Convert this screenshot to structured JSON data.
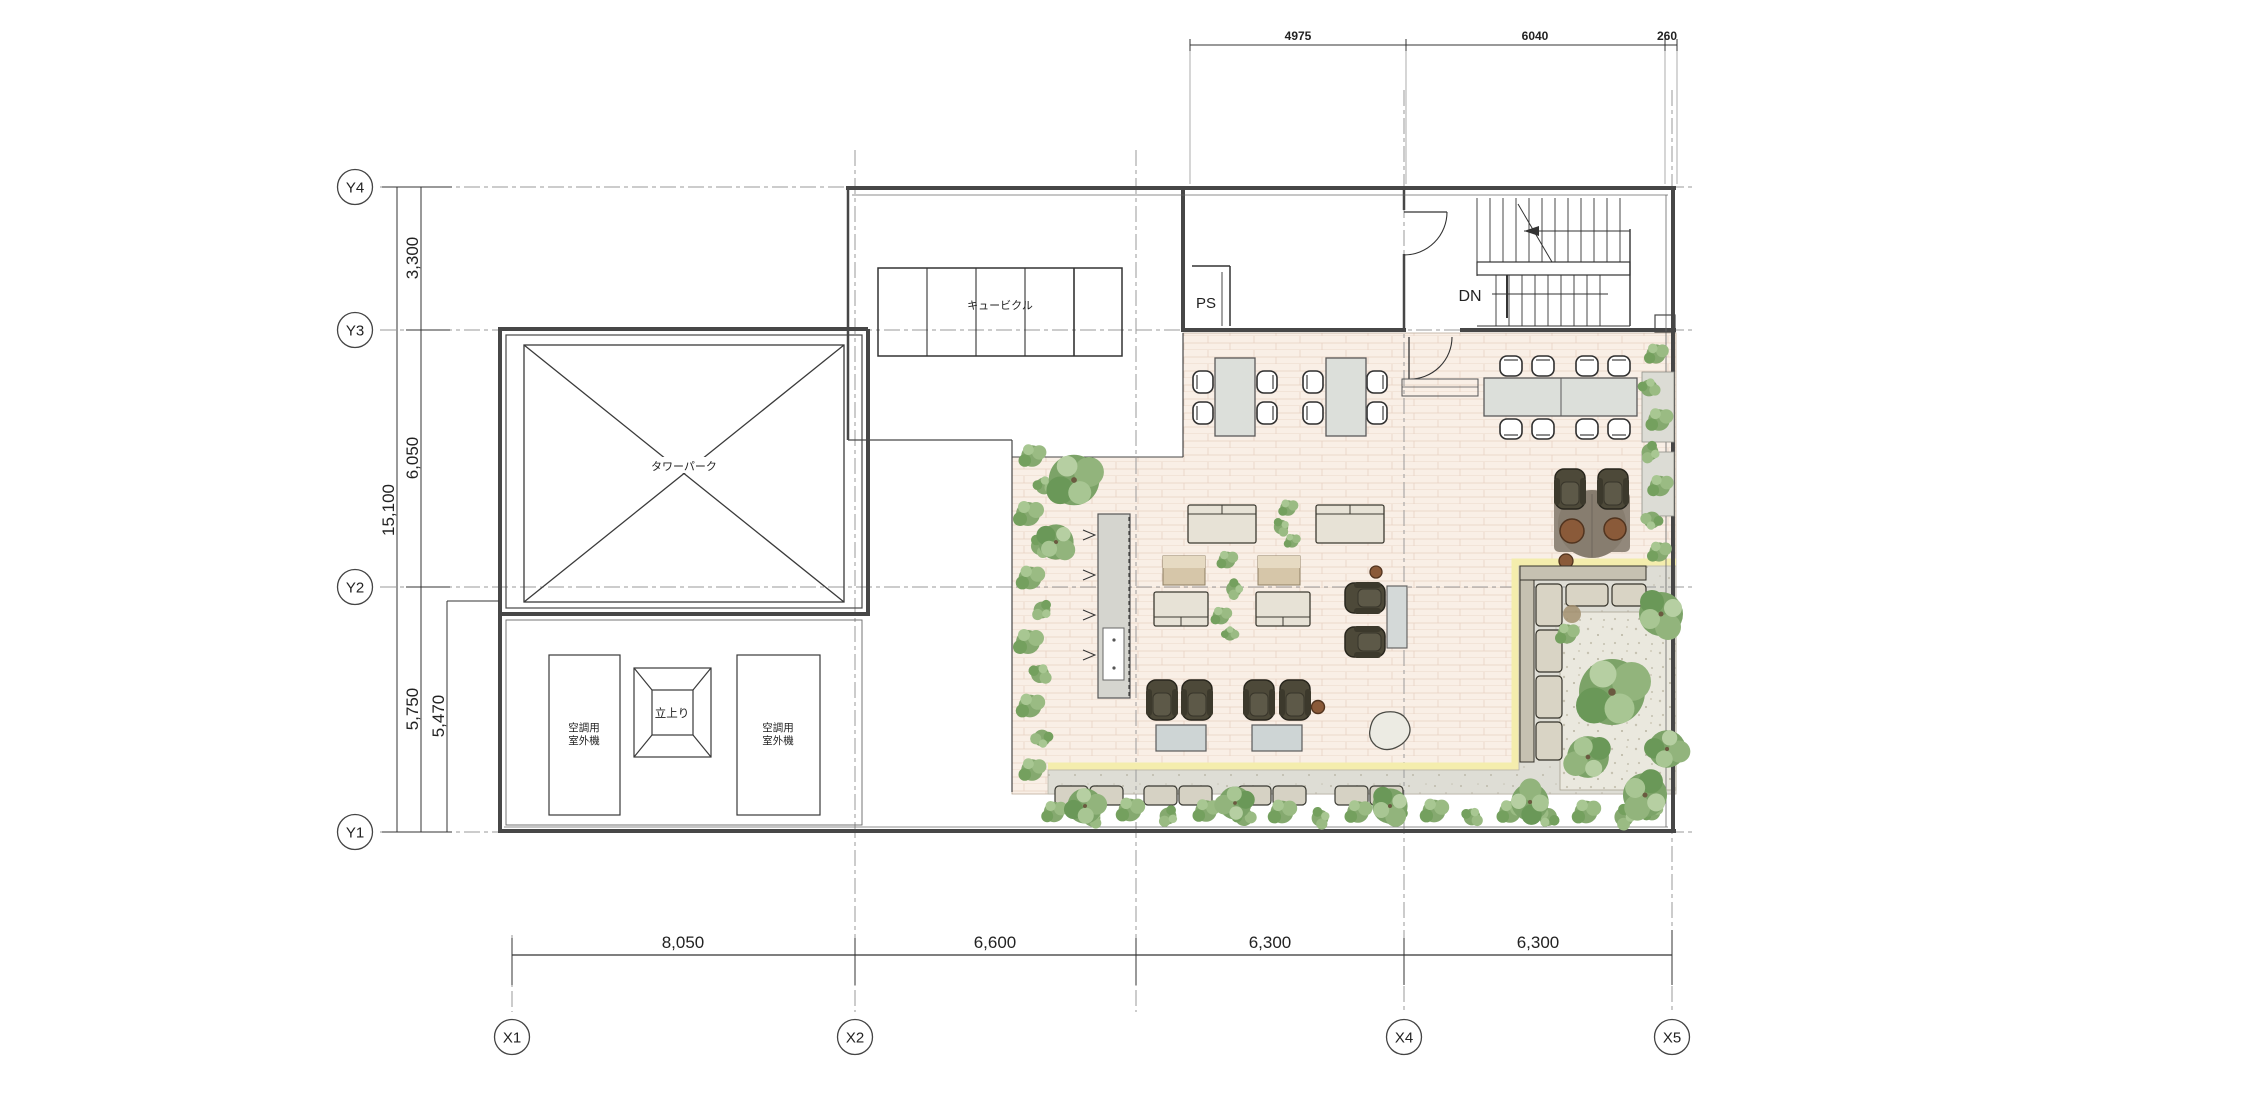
{
  "grid": {
    "y_labels": [
      "Y4",
      "Y3",
      "Y2",
      "Y1"
    ],
    "x_labels": [
      "X1",
      "X2",
      "X4",
      "X5"
    ]
  },
  "dimensions": {
    "left_total": "15,100",
    "left_segments": [
      "3,300",
      "6,050",
      "5,750"
    ],
    "left_inner": "5,470",
    "top": [
      "4975",
      "6040",
      "260"
    ],
    "bottom": [
      "8,050",
      "6,600",
      "6,300",
      "6,300"
    ]
  },
  "labels": {
    "cubicle": "キュービクル",
    "tower_parking": "タワーパーク",
    "pipe_shaft": "PS",
    "down": "DN",
    "ac_line1": "空調用",
    "ac_line2": "室外機",
    "riser": "立上り"
  },
  "colors": {
    "deck_floor": "#f9efe6",
    "deck_stripe": "#ecd8ca",
    "path_highlight": "#f4edad",
    "pavement": "#deddd5",
    "gravel": "#eae8de",
    "hedge_green": "#85a96f",
    "armchair_dark": "#4d4939",
    "sofa_beige": "#e7e2d6",
    "wood_tan": "#d6c6a9",
    "wall": "#474747",
    "grid_line": "#9a9a9a"
  }
}
